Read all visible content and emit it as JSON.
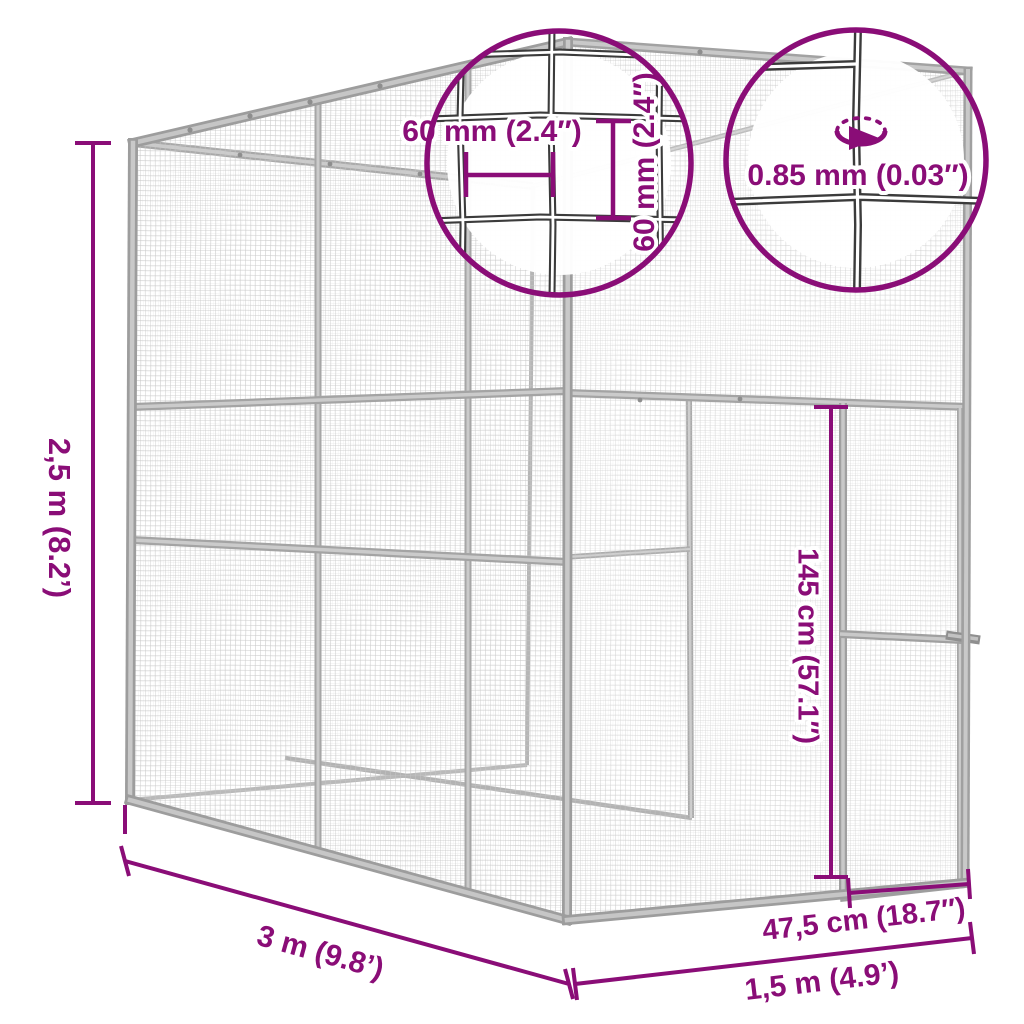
{
  "diagram": {
    "title_semantic": "outdoor-cat-cage-dimension-diagram",
    "accent_color": "#8a0d77",
    "frame_color": "#b3b3b3",
    "mesh_color": "#c8c8c8",
    "dimensions": {
      "height": "2,5 m (8.2’)",
      "depth": "3 m (9.8’)",
      "width": "1,5 m (4.9’)",
      "door_width": "47,5 cm (18.7″)",
      "door_height": "145 cm (57.1″)",
      "mesh_opening_width": "60 mm (2.4″)",
      "mesh_opening_height": "60 mm (2.4″)",
      "wire_thickness": "0.85 mm (0.03″)"
    }
  }
}
